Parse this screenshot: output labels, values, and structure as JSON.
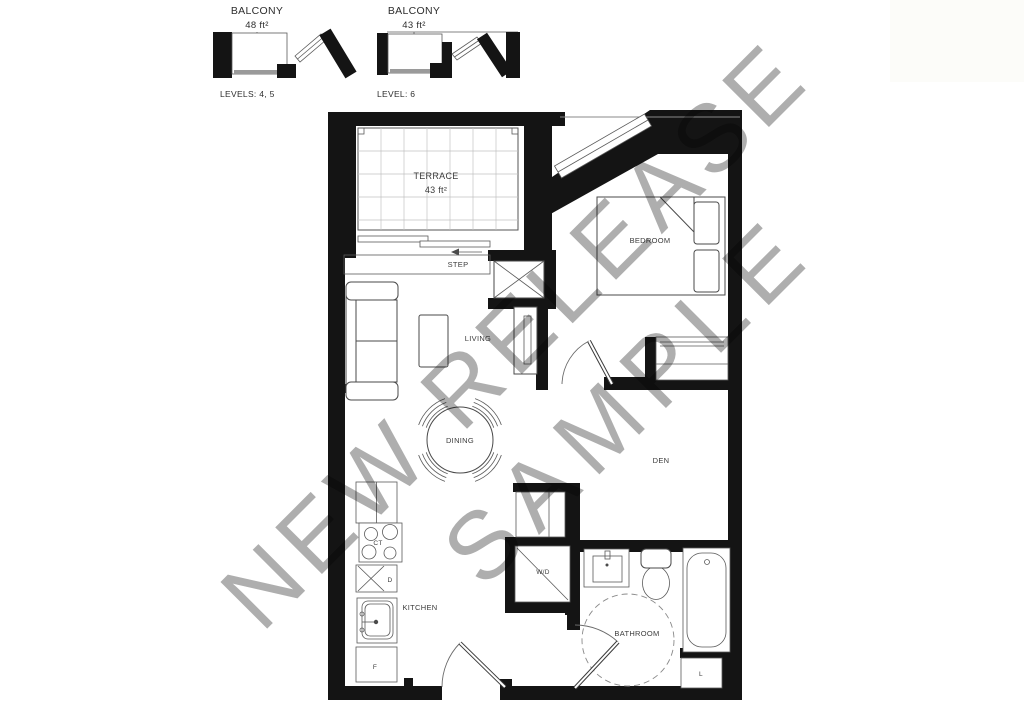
{
  "balconies": [
    {
      "label": "BALCONY",
      "area": "48 ft²",
      "levels": "LEVELS: 4, 5"
    },
    {
      "label": "BALCONY",
      "area": "43 ft²",
      "levels": "LEVEL: 6"
    }
  ],
  "plan": {
    "terrace": {
      "label": "TERRACE",
      "area": "43 ft²"
    },
    "step_label": "STEP",
    "living_label": "LIVING",
    "dining_label": "DINING",
    "kitchen_label": "KITCHEN",
    "bedroom_label": "BEDROOM",
    "den_label": "DEN",
    "bathroom_label": "BATHROOM",
    "fixtures": {
      "cooktop": "CT",
      "dishwasher": "D",
      "fridge": "F",
      "washer_dryer": "W/D",
      "linen": "L"
    }
  },
  "watermark": {
    "line1": "NEW RELEASE",
    "line2": "SAMPLE"
  },
  "colors": {
    "wall": "#141414",
    "line": "#4a4a4a",
    "watermark": "#a8a8a8"
  }
}
